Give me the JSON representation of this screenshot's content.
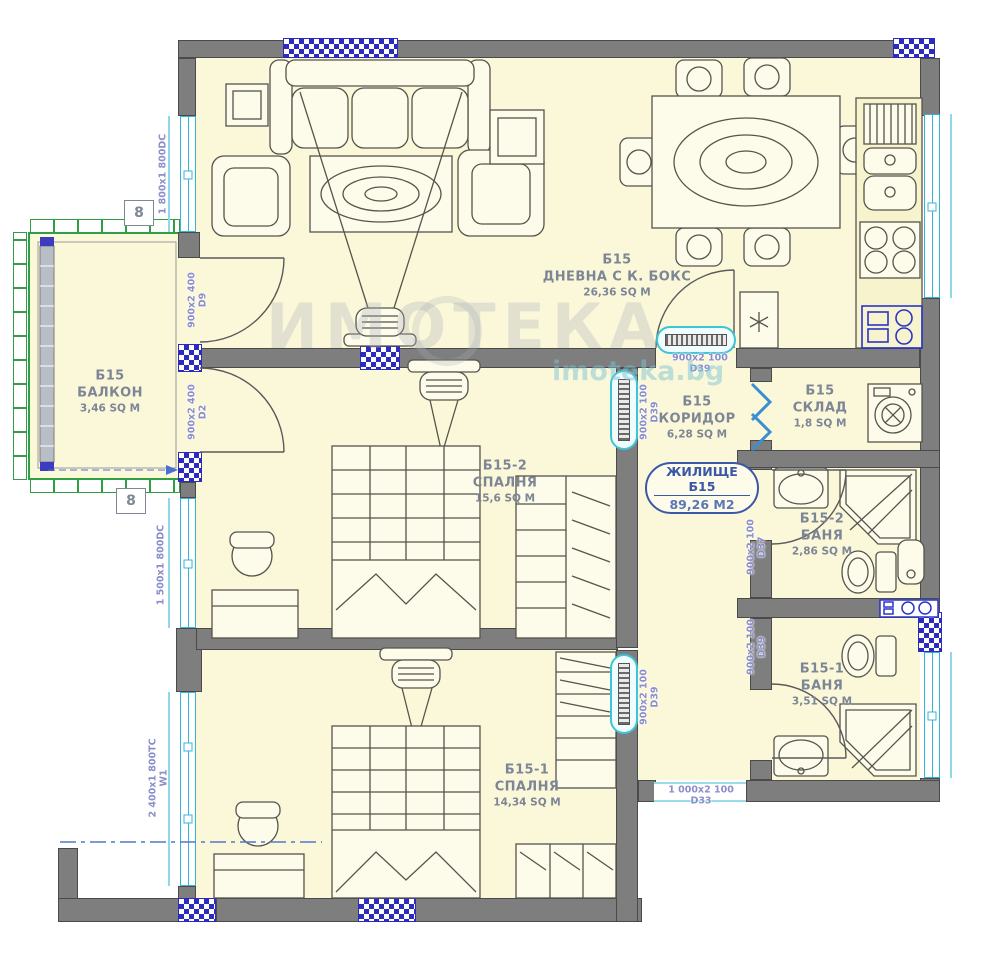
{
  "plan_title": "ЖИЛИЩЕ Б15",
  "badge": {
    "line1": "ЖИЛИЩЕ Б15",
    "line2": "89,26 М2"
  },
  "rooms": {
    "living": {
      "unit": "Б15",
      "name": "ДНЕВНА С К. БОКС",
      "area": "26,36 SQ M"
    },
    "balcony": {
      "unit": "Б15",
      "name": "БАЛКОН",
      "area": "3,46 SQ M"
    },
    "bedroom2": {
      "unit": "Б15-2",
      "name": "СПАЛНЯ",
      "area": "15,6 SQ M"
    },
    "bedroom1": {
      "unit": "Б15-1",
      "name": "СПАЛНЯ",
      "area": "14,34 SQ M"
    },
    "corridor": {
      "unit": "Б15",
      "name": "КОРИДОР",
      "area": "6,28 SQ M"
    },
    "storage": {
      "unit": "Б15",
      "name": "СКЛАД",
      "area": "1,8 SQ M"
    },
    "bath2": {
      "unit": "Б15-2",
      "name": "БАНЯ",
      "area": "2,86 SQ M"
    },
    "bath1": {
      "unit": "Б15-1",
      "name": "БАНЯ",
      "area": "3,51 SQ M"
    }
  },
  "openings": {
    "window_left_top": {
      "size": "1 800x1 800DC"
    },
    "door_d9": {
      "size": "900x2 400",
      "code": "D9"
    },
    "door_d2": {
      "size": "900x2 400",
      "code": "D2"
    },
    "window_left_mid": {
      "size": "1 500x1 800DC"
    },
    "window_left_bottom": {
      "size": "2 400x1 800TC",
      "code": "W1"
    },
    "door_living": {
      "size": "900x2 100",
      "code": "D39"
    },
    "door_bedroom2": {
      "size": "900x2 100",
      "code": "D39"
    },
    "door_bedroom1": {
      "size": "900x2 100",
      "code": "D39"
    },
    "door_bath2": {
      "size": "900x2 100",
      "code": "D37"
    },
    "door_bath1": {
      "size": "900x2 100",
      "code": "D39"
    },
    "door_entrance": {
      "size": "1 000x2 100",
      "code": "D33"
    }
  },
  "markers": {
    "grid_top": "8",
    "grid_bottom": "8"
  },
  "watermark": {
    "brand": "ИМОТЕКА",
    "url": "imoteka.bg"
  },
  "colors": {
    "room_fill": "#fbf8da",
    "wall": "#7e7e7e",
    "column_blue": "#2b2bbf",
    "window_cyan": "#35b4d8",
    "balcony_green": "#2f9e44",
    "room_label": "#7d8695",
    "door_label": "#8a8ecb",
    "badge_blue": "#3a57a8"
  }
}
